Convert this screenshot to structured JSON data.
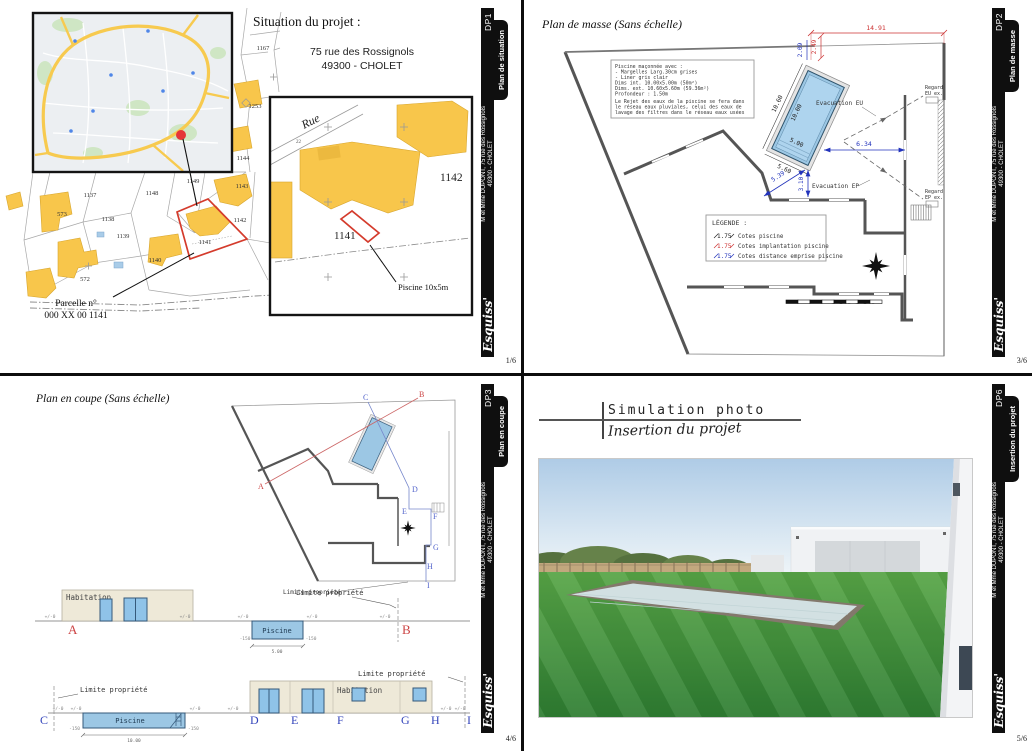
{
  "project": {
    "client_line1": "M et Mme DUPONT, 75 rue des Rossignols",
    "client_line2": "49300 - CHOLET",
    "logo": "Esquiss'"
  },
  "quadrants": {
    "dp1": {
      "tag": "DP1",
      "tab_label": "Plan de situation",
      "page": "1/6",
      "title": "Situation du projet :",
      "address_line1": "75 rue des Rossignols",
      "address_line2": "49300 - CHOLET",
      "parcel_note_line1": "Parcelle n°",
      "parcel_note_line2": "000 XX 00 1141",
      "inset_street": "Rue",
      "inset_house_number": "22",
      "inset_parcel_right": "1142",
      "inset_parcel_selected": "1141",
      "inset_pool_label": "Piscine 10x5m",
      "cadastre": [
        "1167",
        "1253",
        "1144",
        "1143",
        "1149",
        "1148",
        "1137",
        "573",
        "1138",
        "1139",
        "1140",
        "572",
        "1142",
        "1141"
      ]
    },
    "dp2": {
      "tag": "DP2",
      "tab_label": "Plan de masse",
      "page": "3/6",
      "title": "Plan de masse (Sans échelle)",
      "notes": [
        "Piscine maçonnée avec :",
        "- Margelles Larg.30cm grises",
        "- Liner gris clair",
        "Dims int. 10.00x5.00m (50m²)",
        "Dims. ext. 10.60x5.60m (59.36m²)",
        "Profondeur : 1.50m",
        "",
        "Le Rejet des eaux de la piscine se fera dans",
        "le réseau eaux pluviales, celui des eaux de",
        "lavage des filtres dans le réseau eaux usées"
      ],
      "legend_title": "LÉGENDE :",
      "legend": [
        {
          "sample": "1.75",
          "label": "Cotes piscine"
        },
        {
          "sample": "1.75",
          "label": "Cotes implantation piscine"
        },
        {
          "sample": "1.75",
          "label": "Cotes distance emprise piscine"
        }
      ],
      "dims": {
        "top_width": "14.91",
        "offset_red": "2.49",
        "offset_blue": "2.09",
        "to_wall_right": "6.34",
        "to_wall_diag": "5.39",
        "to_wall_down": "3.10",
        "pool_length_int": "10.00",
        "pool_length_ext": "10.60",
        "pool_width_int": "5.00",
        "pool_width_ext": "5.60"
      },
      "labels": {
        "evac_eu": "Evacuation EU",
        "evac_ep": "Evacuation EP",
        "regard_line1": "Regard",
        "regard_eu_line2": "EU ex.",
        "regard_ep_line2": "EP ex."
      },
      "colors": {
        "dim_black": "#222222",
        "dim_red": "#cc3333",
        "dim_blue": "#2233bb",
        "pool_fill": "#9cc7e4"
      }
    },
    "dp3": {
      "tag": "DP3",
      "tab_label": "Plan en coupe",
      "page": "4/6",
      "title": "Plan en coupe (Sans échelle)",
      "habitation": "Habitation",
      "piscine": "Piscine",
      "level_zero": "+/-0",
      "level_minus": "-150",
      "dim_pool_width": "5.00",
      "dim_pool_length": "10.00",
      "limite": "Limite propriété",
      "letters": {
        "A": "A",
        "B": "B",
        "C": "C",
        "D": "D",
        "E": "E",
        "F": "F",
        "G": "G",
        "H": "H",
        "I": "I"
      }
    },
    "dp6": {
      "tag": "DP6",
      "tab_label": "Insertion du projet",
      "page": "5/6",
      "title": "Simulation photo",
      "subtitle": "Insertion du projet"
    }
  }
}
